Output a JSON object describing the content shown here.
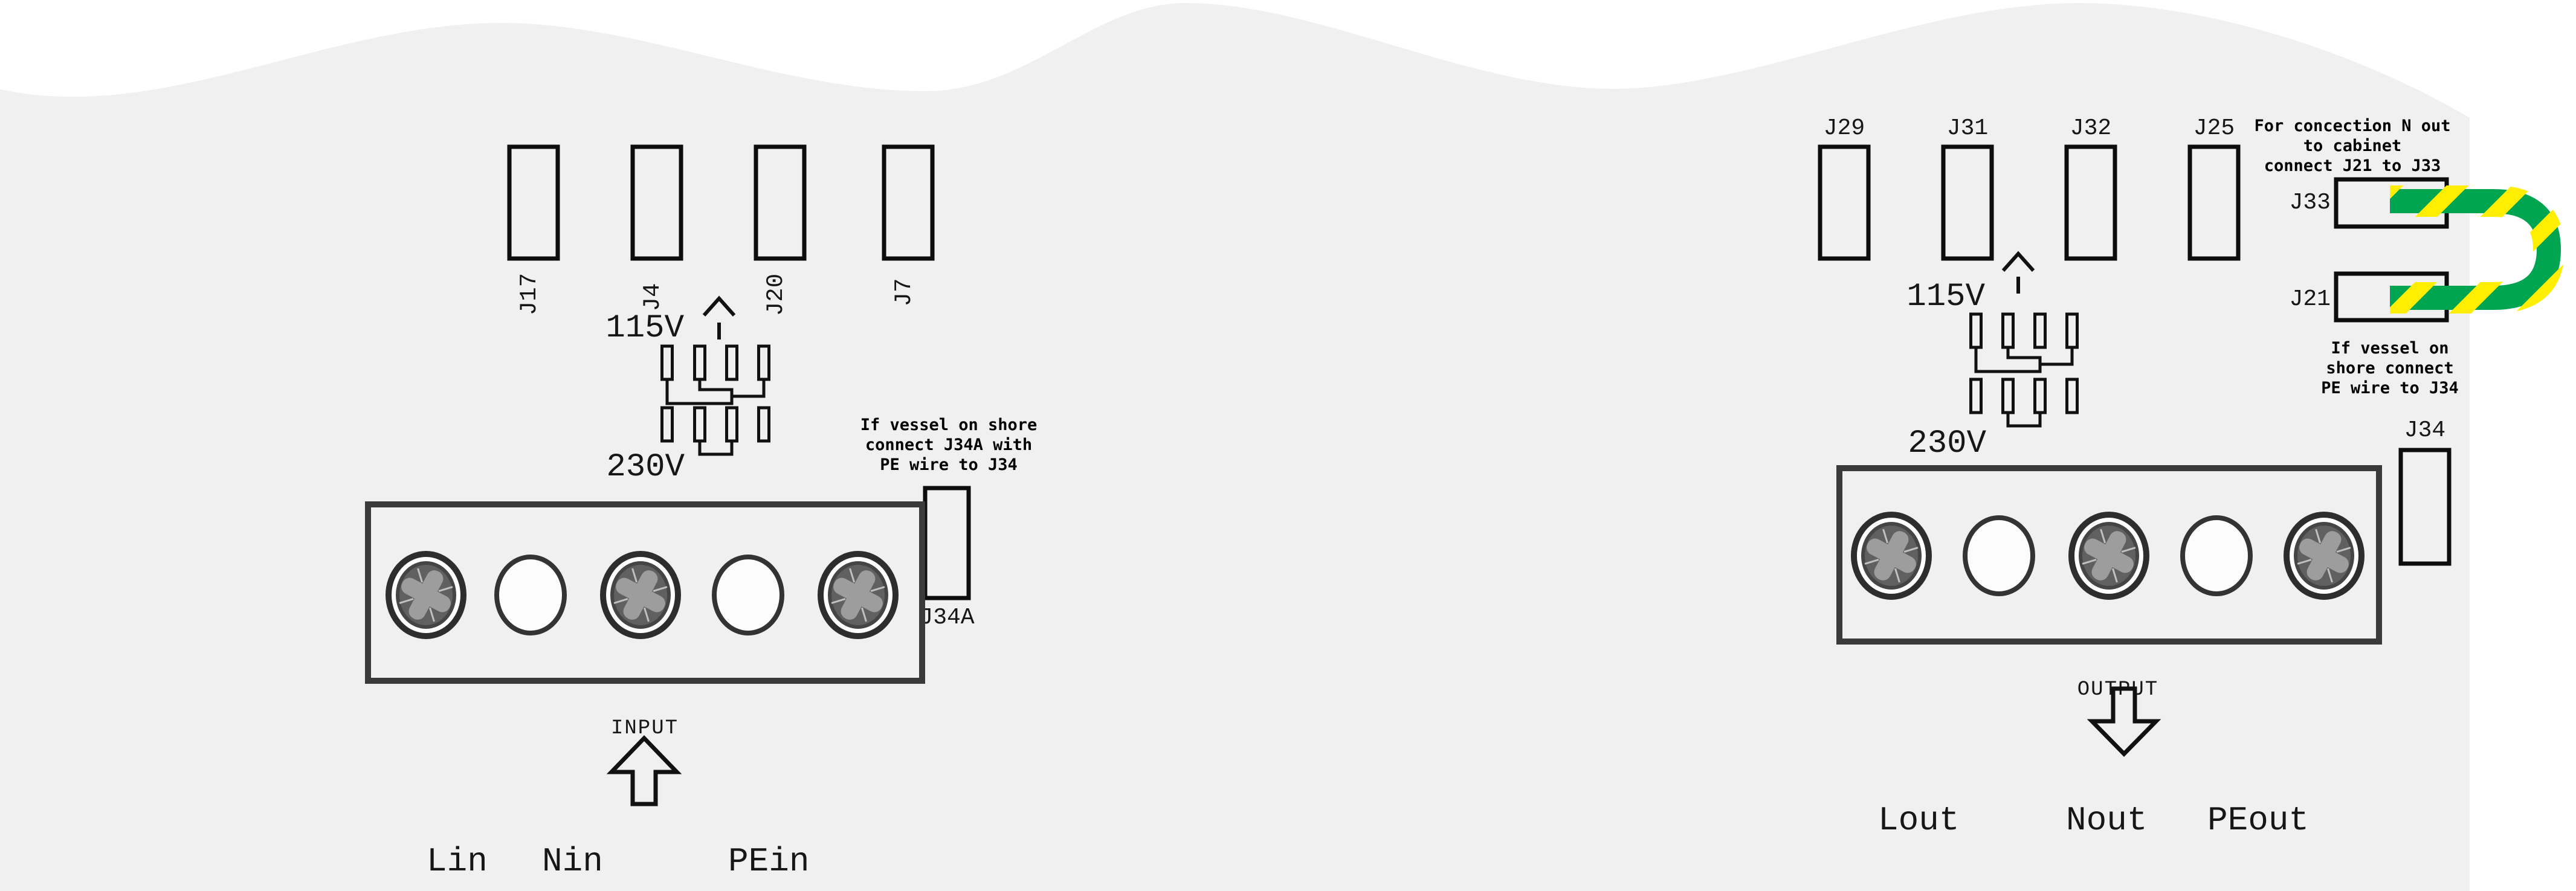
{
  "colors": {
    "board_gray": "#f0f0f0",
    "page_white": "#ffffff",
    "ink": "#111111",
    "terminal_border": "#3a3a3a",
    "wire_green": "#00a551",
    "wire_yellow": "#ffee00",
    "screw_body": "#606060",
    "screw_cross": "#9d9d9d"
  },
  "left_section": {
    "connectors": [
      "J17",
      "J4",
      "J20",
      "J7"
    ],
    "voltage_labels": {
      "v115": "115V",
      "v230": "230V"
    },
    "shore_note": [
      "If vessel on shore",
      "connect J34A with",
      "PE wire to J34"
    ],
    "pe_jumper_connector": "J34A",
    "terminal_label": "INPUT",
    "wire_labels": [
      "Lin",
      "Nin",
      "PEin"
    ]
  },
  "right_section": {
    "connectors": [
      "J29",
      "J31",
      "J32",
      "J25"
    ],
    "voltage_labels": {
      "v115": "115V",
      "v230": "230V"
    },
    "cabinet_note": [
      "For concection N out",
      "to cabinet",
      "connect J21 to J33"
    ],
    "loop_top_connector": "J33",
    "loop_bottom_connector": "J21",
    "shore_note": [
      "If vessel on",
      "shore connect",
      "PE wire to J34"
    ],
    "pe_connector": "J34",
    "terminal_label": "OUTPUT",
    "wire_labels": [
      "Lout",
      "Nout",
      "PEout"
    ]
  }
}
